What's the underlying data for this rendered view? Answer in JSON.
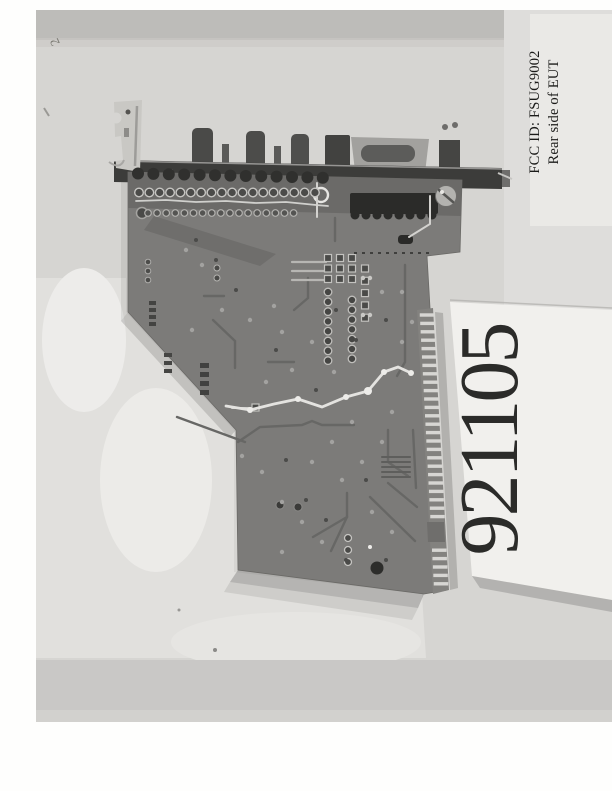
{
  "photo": {
    "corner_mark": "2",
    "side_label": {
      "line1": "FCC ID: FSUG9002",
      "line2": "Rear side of EUT"
    },
    "number_card": {
      "number": "921105"
    },
    "colors": {
      "photo_background": "#d6d5d2",
      "pcb": "#7c7b79",
      "bracket": "#3c3c3a",
      "edge_connector_fingers": "#d7d6d3",
      "label_card": "#f1f0ed",
      "text": "#1b1b19"
    }
  }
}
